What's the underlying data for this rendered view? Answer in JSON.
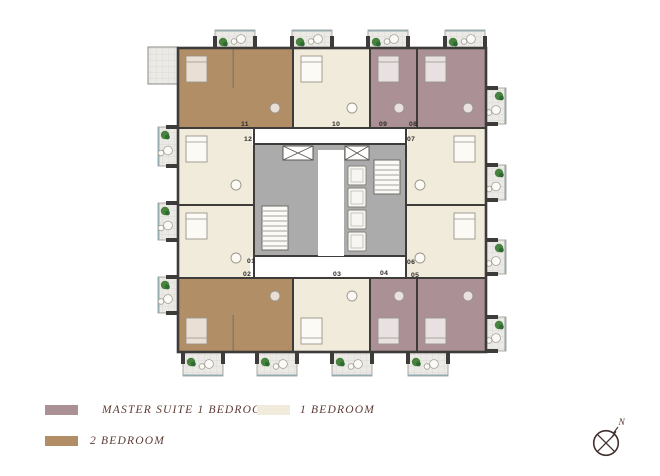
{
  "palette": {
    "master_suite": "#ab9195",
    "one_bedroom": "#f1ebdb",
    "two_bedroom": "#b28e66",
    "wall": "#3e3c3a",
    "core_gray": "#ababab",
    "balcony_floor": "#eceae6",
    "balcony_grid": "#d8d6d0",
    "glass": "#93abae",
    "plant_green": "#47833f",
    "plant_dark": "#2e6b33",
    "legend_text": "#5c3a35",
    "unit_label": "#2e2c2a"
  },
  "legend": {
    "items": [
      {
        "label": "MASTER SUITE 1 BEDROOM",
        "color_key": "master_suite"
      },
      {
        "label": "1 BEDROOM",
        "color_key": "one_bedroom"
      },
      {
        "label": "2  BEDROOM",
        "color_key": "two_bedroom"
      }
    ]
  },
  "compass": {
    "label": "N"
  },
  "floor_plan": {
    "units": [
      {
        "number": "01",
        "type": "one_bedroom",
        "x": 178,
        "y": 205,
        "w": 76,
        "h": 73,
        "lx": 247,
        "ly": 263
      },
      {
        "number": "02",
        "type": "two_bedroom",
        "x": 178,
        "y": 278,
        "w": 115,
        "h": 74,
        "lx": 243,
        "ly": 276
      },
      {
        "number": "03",
        "type": "one_bedroom",
        "x": 293,
        "y": 278,
        "w": 77,
        "h": 74,
        "lx": 333,
        "ly": 276
      },
      {
        "number": "04",
        "type": "master_suite",
        "x": 370,
        "y": 278,
        "w": 47,
        "h": 74,
        "lx": 380,
        "ly": 275
      },
      {
        "number": "05",
        "type": "master_suite",
        "x": 417,
        "y": 278,
        "w": 69,
        "h": 74,
        "lx": 411,
        "ly": 277
      },
      {
        "number": "06",
        "type": "one_bedroom",
        "x": 406,
        "y": 205,
        "w": 80,
        "h": 73,
        "lx": 407,
        "ly": 264
      },
      {
        "number": "07",
        "type": "one_bedroom",
        "x": 406,
        "y": 128,
        "w": 80,
        "h": 77,
        "lx": 407,
        "ly": 141
      },
      {
        "number": "08",
        "type": "master_suite",
        "x": 417,
        "y": 48,
        "w": 69,
        "h": 80,
        "lx": 409,
        "ly": 126
      },
      {
        "number": "09",
        "type": "master_suite",
        "x": 370,
        "y": 48,
        "w": 47,
        "h": 80,
        "lx": 379,
        "ly": 126
      },
      {
        "number": "10",
        "type": "one_bedroom",
        "x": 293,
        "y": 48,
        "w": 77,
        "h": 80,
        "lx": 332,
        "ly": 126
      },
      {
        "number": "11",
        "type": "two_bedroom",
        "x": 178,
        "y": 48,
        "w": 115,
        "h": 80,
        "lx": 241,
        "ly": 126
      },
      {
        "number": "12",
        "type": "one_bedroom",
        "x": 178,
        "y": 128,
        "w": 76,
        "h": 77,
        "lx": 244,
        "ly": 141
      }
    ],
    "balconies": [
      {
        "side": "top",
        "x": 215,
        "y": 30,
        "w": 40,
        "h": 18
      },
      {
        "side": "top",
        "x": 292,
        "y": 30,
        "w": 40,
        "h": 18
      },
      {
        "side": "top",
        "x": 368,
        "y": 30,
        "w": 40,
        "h": 18
      },
      {
        "side": "top",
        "x": 445,
        "y": 30,
        "w": 40,
        "h": 18
      },
      {
        "side": "bottom",
        "x": 183,
        "y": 352,
        "w": 40,
        "h": 24
      },
      {
        "side": "bottom",
        "x": 257,
        "y": 352,
        "w": 40,
        "h": 24
      },
      {
        "side": "bottom",
        "x": 332,
        "y": 352,
        "w": 40,
        "h": 24
      },
      {
        "side": "bottom",
        "x": 408,
        "y": 352,
        "w": 40,
        "h": 24
      },
      {
        "side": "left",
        "x": 158,
        "y": 127,
        "w": 20,
        "h": 39
      },
      {
        "side": "left",
        "x": 158,
        "y": 203,
        "w": 20,
        "h": 37
      },
      {
        "side": "left",
        "x": 158,
        "y": 277,
        "w": 20,
        "h": 36
      },
      {
        "side": "right",
        "x": 486,
        "y": 88,
        "w": 20,
        "h": 36
      },
      {
        "side": "right",
        "x": 486,
        "y": 165,
        "w": 20,
        "h": 35
      },
      {
        "side": "right",
        "x": 486,
        "y": 240,
        "w": 20,
        "h": 34
      },
      {
        "side": "right",
        "x": 486,
        "y": 317,
        "w": 20,
        "h": 34
      }
    ],
    "terrace": {
      "x": 148,
      "y": 47,
      "w": 30,
      "h": 37
    }
  }
}
